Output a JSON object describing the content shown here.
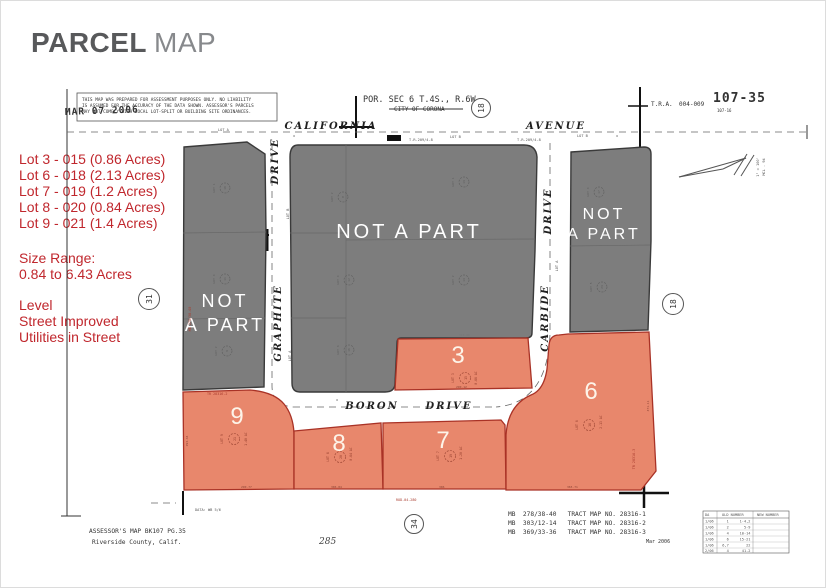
{
  "title": {
    "primary": "PARCEL",
    "secondary": "MAP"
  },
  "info": {
    "lots": [
      "Lot 3 - 015 (0.86 Acres)",
      "Lot 6 - 018 (2.13 Acres)",
      "Lot 7 - 019 (1.2 Acres)",
      "Lot 8 - 020 (0.84 Acres)",
      "Lot 9 - 021 (1.4 Acres)"
    ],
    "size_range_label": "Size Range:",
    "size_range_value": "0.84 to 6.43 Acres",
    "features": [
      "Level",
      "Street Improved",
      "Utilities in Street"
    ]
  },
  "colors": {
    "accent_red": "#c0272d",
    "parcel_orange": "#e8876c",
    "parcel_gray": "#7d7d7d"
  },
  "map": {
    "disclaimer_line1": "THIS MAP WAS PREPARED FOR ASSESSMENT PURPOSES ONLY. NO LIABILITY",
    "disclaimer_line2": "IS ASSUMED FOR THE ACCURACY OF THE DATA SHOWN. ASSESSOR'S PARCELS",
    "disclaimer_line3": "MAY NOT COMPLY WITH LOCAL LOT-SPLIT OR BUILDING SITE ORDINANCES.",
    "date_stamp": "MAR 07 2006",
    "por_sec": "POR. SEC 6 T.4S., R.6W",
    "city": "CITY OF CORONA",
    "tra_label": "T.R.A.",
    "tra_value": "004-009",
    "sheet_number": "107-35",
    "sheet_sub": "107-16",
    "nap": "NOT A PART",
    "nap1": "NOT",
    "nap2": "A PART",
    "streets": {
      "california": "CALIFORNIA",
      "avenue": "AVENUE",
      "graphite": "GRAPHITE",
      "carbide": "CARBIDE",
      "boron": "BORON",
      "drive": "DRIVE"
    },
    "edge": {
      "lot_a": "LOT A",
      "lot_b": "LOT B",
      "tr209": "T.R.209/4-8",
      "x": "x"
    },
    "scale1": "1\" = 100'",
    "scale2": "MCL - 94",
    "parcels": {
      "p3": {
        "num": "3",
        "lot": "LOT 3",
        "pin": "15",
        "acres": "0.86 AC",
        "dim_top": "318.80",
        "dim_bottom": "290.12"
      },
      "p6": {
        "num": "6",
        "lot": "LOT 6",
        "pin": "18",
        "acres": "2.13 AC",
        "dim_right": "471.11",
        "dim_bottom": "365.71",
        "tr": "TR 28316-3"
      },
      "p7": {
        "num": "7",
        "lot": "LOT 7",
        "pin": "19",
        "acres": "1.20 AC",
        "dim_bottom": "306"
      },
      "p8": {
        "num": "8",
        "lot": "LOT 8",
        "pin": "20",
        "acres": "0.84 AC",
        "dim_bottom": "306.84"
      },
      "p9": {
        "num": "9",
        "lot": "LOT 9",
        "pin": "21",
        "acres": "1.40 AC",
        "dim_bottom": "290.77",
        "dim_left": "293.44",
        "tr": "TR 28316-2"
      }
    },
    "ghosts": [
      {
        "lot": "LOT 1",
        "pin": "10"
      },
      {
        "lot": "LOT 4",
        "pin": "11"
      },
      {
        "lot": "LOT 2",
        "pin": "9"
      },
      {
        "lot": "LOT 2",
        "pin": "8"
      },
      {
        "lot": "LOT 1",
        "pin": "13"
      },
      {
        "lot": "LOT 4",
        "pin": "12"
      },
      {
        "lot": "LOT 2",
        "pin": "14"
      },
      {
        "lot": "LOT 3",
        "pin": "16"
      },
      {
        "lot": "LOT 4",
        "pin": "17"
      },
      {
        "lot": "LOT 5",
        "pin": "23"
      }
    ],
    "circles": {
      "west": "31",
      "east": "18",
      "top": "18",
      "south": "34"
    },
    "notes": {
      "west_ref": "MB 278/38-40",
      "rod": "ROD-04-280"
    },
    "footer": {
      "assessor1": "ASSESSOR'S MAP BK107 PG.35",
      "assessor2": "Riverside County, Calif.",
      "page_num": "285",
      "data_note": "DATA: WB 5/6",
      "tract1": "MB  278/38-40   TRACT MAP NO. 28316-1",
      "tract2": "MB  303/12-14   TRACT MAP NO. 28316-2",
      "tract3": "MB  369/33-36   TRACT MAP NO. 28316-3",
      "date": "Mar 2006"
    },
    "table": {
      "col1": "DA",
      "col2": "OLD NUMBER",
      "col3": "NEW NUMBER",
      "rows": [
        "1/06      1     1-4,2",
        "1/06      2       5-9",
        "1/06      4     10-14",
        "1/06      6     15-21",
        "1/06    6,7        22",
        "2/06      4      41-2"
      ]
    }
  }
}
